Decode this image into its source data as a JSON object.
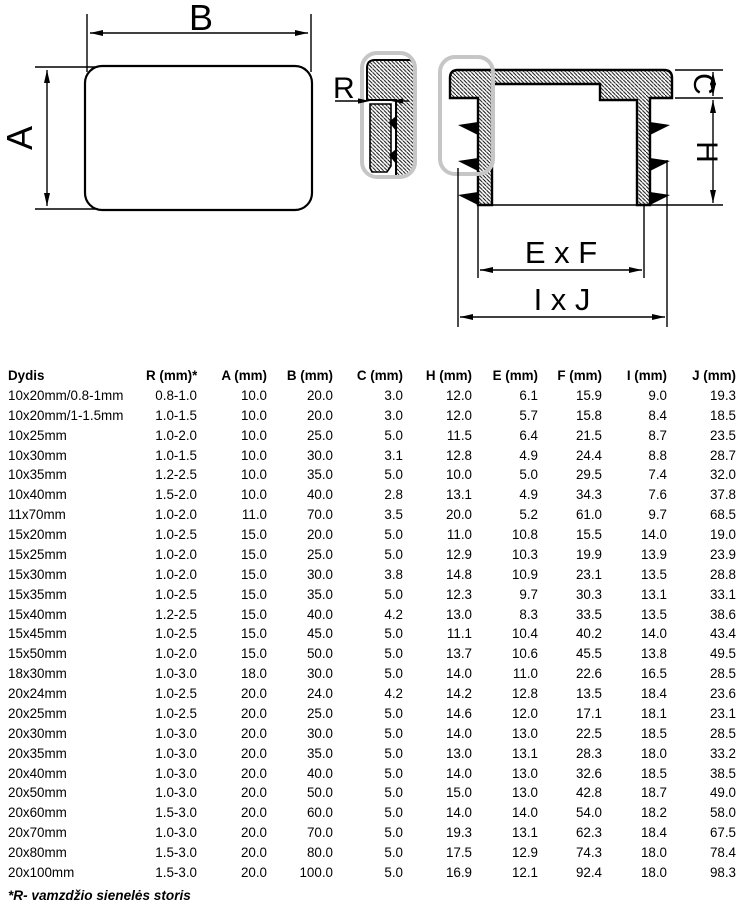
{
  "drawing": {
    "labels": {
      "width": "B",
      "height": "A",
      "wall": "R",
      "flange": "C",
      "insert_height": "H",
      "inner_dim": "E x F",
      "outer_dim": "I x J"
    },
    "colors": {
      "line": "#000000",
      "callout": "#c6c6c6",
      "background": "#ffffff"
    }
  },
  "table": {
    "columns": [
      "Dydis",
      "R (mm)*",
      "A (mm)",
      "B (mm)",
      "C (mm)",
      "H (mm)",
      "E (mm)",
      "F (mm)",
      "I (mm)",
      "J (mm)"
    ],
    "rows": [
      [
        "10x20mm/0.8-1mm",
        "0.8-1.0",
        "10.0",
        "20.0",
        "3.0",
        "12.0",
        "6.1",
        "15.9",
        "9.0",
        "19.3"
      ],
      [
        "10x20mm/1-1.5mm",
        "1.0-1.5",
        "10.0",
        "20.0",
        "3.0",
        "12.0",
        "5.7",
        "15.8",
        "8.4",
        "18.5"
      ],
      [
        "10x25mm",
        "1.0-2.0",
        "10.0",
        "25.0",
        "5.0",
        "11.5",
        "6.4",
        "21.5",
        "8.7",
        "23.5"
      ],
      [
        "10x30mm",
        "1.0-1.5",
        "10.0",
        "30.0",
        "3.1",
        "12.8",
        "4.9",
        "24.4",
        "8.8",
        "28.7"
      ],
      [
        "10x35mm",
        "1.2-2.5",
        "10.0",
        "35.0",
        "5.0",
        "10.0",
        "5.0",
        "29.5",
        "7.4",
        "32.0"
      ],
      [
        "10x40mm",
        "1.5-2.0",
        "10.0",
        "40.0",
        "2.8",
        "13.1",
        "4.9",
        "34.3",
        "7.6",
        "37.8"
      ],
      [
        "11x70mm",
        "1.0-2.0",
        "11.0",
        "70.0",
        "3.5",
        "20.0",
        "5.2",
        "61.0",
        "9.7",
        "68.5"
      ],
      [
        "15x20mm",
        "1.0-2.5",
        "15.0",
        "20.0",
        "5.0",
        "11.0",
        "10.8",
        "15.5",
        "14.0",
        "19.0"
      ],
      [
        "15x25mm",
        "1.0-2.0",
        "15.0",
        "25.0",
        "5.0",
        "12.9",
        "10.3",
        "19.9",
        "13.9",
        "23.9"
      ],
      [
        "15x30mm",
        "1.0-2.0",
        "15.0",
        "30.0",
        "3.8",
        "14.8",
        "10.9",
        "23.1",
        "13.5",
        "28.8"
      ],
      [
        "15x35mm",
        "1.0-2.5",
        "15.0",
        "35.0",
        "5.0",
        "12.3",
        "9.7",
        "30.3",
        "13.1",
        "33.1"
      ],
      [
        "15x40mm",
        "1.2-2.5",
        "15.0",
        "40.0",
        "4.2",
        "13.0",
        "8.3",
        "33.5",
        "13.5",
        "38.6"
      ],
      [
        "15x45mm",
        "1.0-2.5",
        "15.0",
        "45.0",
        "5.0",
        "11.1",
        "10.4",
        "40.2",
        "14.0",
        "43.4"
      ],
      [
        "15x50mm",
        "1.0-2.0",
        "15.0",
        "50.0",
        "5.0",
        "13.7",
        "10.6",
        "45.5",
        "13.8",
        "49.5"
      ],
      [
        "18x30mm",
        "1.0-3.0",
        "18.0",
        "30.0",
        "5.0",
        "14.0",
        "11.0",
        "22.6",
        "16.5",
        "28.5"
      ],
      [
        "20x24mm",
        "1.0-2.5",
        "20.0",
        "24.0",
        "4.2",
        "14.2",
        "12.8",
        "13.5",
        "18.4",
        "23.6"
      ],
      [
        "20x25mm",
        "1.0-2.5",
        "20.0",
        "25.0",
        "5.0",
        "14.6",
        "12.0",
        "17.1",
        "18.1",
        "23.1"
      ],
      [
        "20x30mm",
        "1.0-3.0",
        "20.0",
        "30.0",
        "5.0",
        "14.0",
        "13.0",
        "22.5",
        "18.5",
        "28.5"
      ],
      [
        "20x35mm",
        "1.0-3.0",
        "20.0",
        "35.0",
        "5.0",
        "13.0",
        "13.1",
        "28.3",
        "18.0",
        "33.2"
      ],
      [
        "20x40mm",
        "1.0-3.0",
        "20.0",
        "40.0",
        "5.0",
        "14.0",
        "13.0",
        "32.6",
        "18.5",
        "38.5"
      ],
      [
        "20x50mm",
        "1.0-3.0",
        "20.0",
        "50.0",
        "5.0",
        "15.0",
        "13.0",
        "42.8",
        "18.7",
        "49.0"
      ],
      [
        "20x60mm",
        "1.5-3.0",
        "20.0",
        "60.0",
        "5.0",
        "14.0",
        "14.0",
        "54.0",
        "18.2",
        "58.0"
      ],
      [
        "20x70mm",
        "1.0-3.0",
        "20.0",
        "70.0",
        "5.0",
        "19.3",
        "13.1",
        "62.3",
        "18.4",
        "67.5"
      ],
      [
        "20x80mm",
        "1.5-3.0",
        "20.0",
        "80.0",
        "5.0",
        "17.5",
        "12.9",
        "74.3",
        "18.0",
        "78.4"
      ],
      [
        "20x100mm",
        "1.5-3.0",
        "20.0",
        "100.0",
        "5.0",
        "16.9",
        "12.1",
        "92.4",
        "18.0",
        "98.3"
      ]
    ],
    "footnote": "*R- vamzdžio sienelės storis"
  }
}
